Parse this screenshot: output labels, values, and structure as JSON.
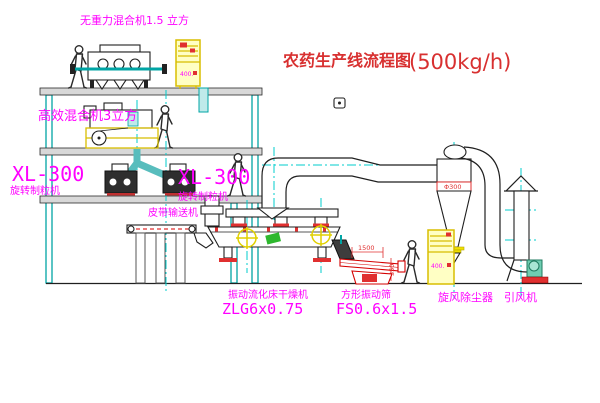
{
  "title": {
    "name": "农药生产线流程图",
    "capacity": "(500kg/h)"
  },
  "labels": {
    "top_mixer": "无重力混合机1.5 立方",
    "mid_mixer": "高效混合机3立方",
    "granulator_left_model": "XL-300",
    "granulator_left_name": "旋转制粒机",
    "granulator_right_model": "XL-300",
    "granulator_right_name": "旋转制粒机",
    "belt_conveyor": "皮带输送机",
    "dryer_name": "振动流化床干燥机",
    "dryer_model": "ZLG6x0.75",
    "screen_name": "方形振动筛",
    "screen_model": "FS0.6x1.5",
    "cyclone": "旋风除尘器",
    "fan": "引风机"
  },
  "annotations": {
    "deck_length": "1500",
    "deck_height": "350",
    "cyclone_size": "Φ300",
    "cabinet_top": "400.",
    "cabinet_right": "400."
  },
  "colors": {
    "structure_teal": "#00a5a5",
    "centerline_cyan": "#00cdcd",
    "equipment_black": "#1f1f1f",
    "label_magenta": "#ff00ff",
    "accent_red": "#d83030",
    "cabinet_yellow": "#ffffc4",
    "motor_yellow": "#e0d000",
    "logo_green": "#2eb82e",
    "slab_gray": "#d8d8d8"
  }
}
